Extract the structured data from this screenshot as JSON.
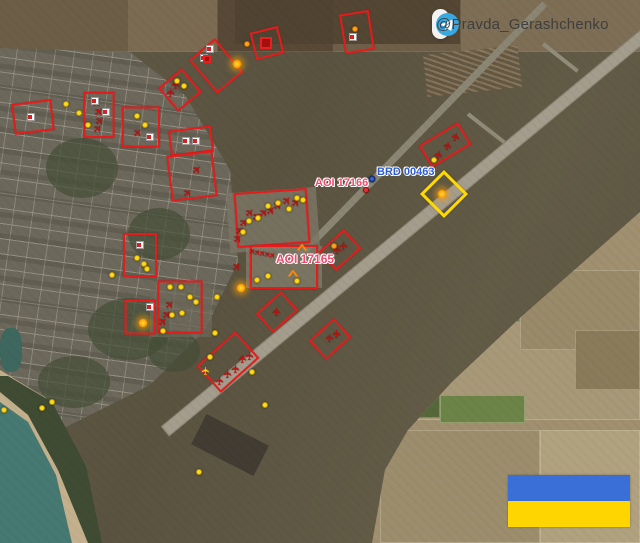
{
  "watermark": {
    "handle": "@Pravda_Gerashchenko",
    "icon": "telegram-icon",
    "icon_color": "#38a9e0",
    "pill_color": "#ffffff",
    "text_color": "#3f3f3f"
  },
  "flag": {
    "name": "ukraine-flag",
    "top_color": "#3a6fd8",
    "bottom_color": "#ffd500"
  },
  "map_labels": {
    "aoi_17166": {
      "text": "AOI 17166",
      "x": 315,
      "y": 177,
      "color": "#f04a6e"
    },
    "brd_00463": {
      "text": "BRD 00463",
      "x": 377,
      "y": 166,
      "color": "#2d5bd0"
    },
    "aoi_17165": {
      "text": "AOI 17165",
      "x": 276,
      "y": 252,
      "color": "#f04a6e"
    }
  },
  "annotations": {
    "box_color": "#e51c1c",
    "dot_color": "#ffd91c",
    "diamond": {
      "x": 444,
      "y": 194,
      "size": 34,
      "color": "#ffd900"
    },
    "boxes": [
      [
        33,
        117,
        40,
        31,
        -7
      ],
      [
        99,
        115,
        31,
        46,
        0
      ],
      [
        141,
        127,
        38,
        41,
        0
      ],
      [
        180,
        90,
        31,
        31,
        -40
      ],
      [
        216,
        66,
        34,
        44,
        -40
      ],
      [
        267,
        43,
        29,
        28,
        -14
      ],
      [
        191,
        141,
        43,
        26,
        -7
      ],
      [
        192,
        176,
        46,
        46,
        -7
      ],
      [
        140,
        255,
        34,
        44,
        0
      ],
      [
        140,
        317,
        31,
        35,
        0
      ],
      [
        180,
        307,
        45,
        53,
        0
      ],
      [
        228,
        362,
        52,
        36,
        -42
      ],
      [
        277,
        312,
        34,
        26,
        -42
      ],
      [
        330,
        339,
        34,
        26,
        -42
      ],
      [
        357,
        32,
        30,
        40,
        -9
      ],
      [
        445,
        145,
        46,
        26,
        -31
      ],
      [
        340,
        250,
        34,
        26,
        -42
      ],
      [
        272,
        218,
        73,
        55,
        -4
      ],
      [
        284,
        267,
        68,
        44,
        0
      ]
    ],
    "planes": [
      [
        97,
        103,
        0
      ],
      [
        99,
        112,
        0
      ],
      [
        100,
        121,
        0
      ],
      [
        98,
        129,
        0
      ],
      [
        138,
        133,
        0
      ],
      [
        176,
        85,
        -40
      ],
      [
        171,
        93,
        -40
      ],
      [
        197,
        170,
        0
      ],
      [
        188,
        193,
        0
      ],
      [
        170,
        305,
        0
      ],
      [
        167,
        315,
        0
      ],
      [
        163,
        322,
        0
      ],
      [
        220,
        381,
        -42
      ],
      [
        228,
        374,
        -42
      ],
      [
        236,
        369,
        -42
      ],
      [
        243,
        359,
        -42
      ],
      [
        250,
        356,
        -42
      ],
      [
        277,
        312,
        -42
      ],
      [
        330,
        338,
        -42
      ],
      [
        337,
        334,
        -42
      ],
      [
        456,
        137,
        -31
      ],
      [
        448,
        146,
        -31
      ],
      [
        439,
        155,
        -31
      ],
      [
        338,
        250,
        -42
      ],
      [
        344,
        246,
        -42
      ],
      [
        250,
        213,
        0
      ],
      [
        257,
        217,
        0
      ],
      [
        264,
        213,
        0
      ],
      [
        271,
        211,
        0
      ],
      [
        278,
        206,
        0
      ],
      [
        287,
        201,
        0
      ],
      [
        296,
        203,
        0
      ],
      [
        244,
        223,
        0
      ],
      [
        240,
        231,
        0
      ],
      [
        238,
        239,
        0
      ],
      [
        253,
        252,
        0,
        1
      ],
      [
        258,
        253,
        0,
        1
      ],
      [
        263,
        254,
        0,
        1
      ],
      [
        268,
        255,
        0,
        1
      ],
      [
        273,
        256,
        0,
        1
      ],
      [
        237,
        267,
        0
      ]
    ],
    "yellow_plane": [
      206,
      371,
      -42
    ],
    "dots_yellow": [
      [
        66,
        104
      ],
      [
        79,
        113
      ],
      [
        88,
        125
      ],
      [
        112,
        275
      ],
      [
        137,
        116
      ],
      [
        145,
        125
      ],
      [
        177,
        81
      ],
      [
        184,
        86
      ],
      [
        434,
        160
      ],
      [
        137,
        258
      ],
      [
        144,
        264
      ],
      [
        147,
        269
      ],
      [
        170,
        287
      ],
      [
        181,
        287
      ],
      [
        190,
        297
      ],
      [
        196,
        302
      ],
      [
        172,
        315
      ],
      [
        182,
        313
      ],
      [
        163,
        331
      ],
      [
        243,
        232
      ],
      [
        249,
        221
      ],
      [
        258,
        218
      ],
      [
        268,
        206
      ],
      [
        278,
        203
      ],
      [
        289,
        209
      ],
      [
        297,
        198
      ],
      [
        303,
        200
      ],
      [
        257,
        280
      ],
      [
        268,
        276
      ],
      [
        297,
        281
      ],
      [
        215,
        333
      ],
      [
        252,
        372
      ],
      [
        265,
        405
      ],
      [
        199,
        472
      ],
      [
        42,
        408
      ],
      [
        52,
        402
      ],
      [
        4,
        410
      ],
      [
        217,
        297
      ],
      [
        210,
        357
      ]
    ],
    "dots_orange": [
      [
        247,
        44
      ],
      [
        355,
        29
      ],
      [
        334,
        246
      ]
    ],
    "dots_glow": [
      [
        237,
        64
      ],
      [
        143,
        323
      ],
      [
        241,
        288
      ],
      [
        442,
        194
      ]
    ],
    "blue_marker": [
      372,
      179
    ],
    "red_marker": [
      366,
      190
    ],
    "white_cross_icons": [
      [
        31,
        117
      ],
      [
        95,
        101
      ],
      [
        106,
        112
      ],
      [
        150,
        137
      ],
      [
        210,
        49
      ],
      [
        204,
        58
      ],
      [
        186,
        141
      ],
      [
        196,
        141
      ],
      [
        140,
        245
      ],
      [
        150,
        307
      ],
      [
        353,
        37
      ]
    ],
    "red_squares": [
      [
        266,
        43,
        12
      ],
      [
        207,
        59,
        8
      ]
    ],
    "chevrons": [
      [
        302,
        247
      ],
      [
        293,
        273
      ]
    ]
  }
}
